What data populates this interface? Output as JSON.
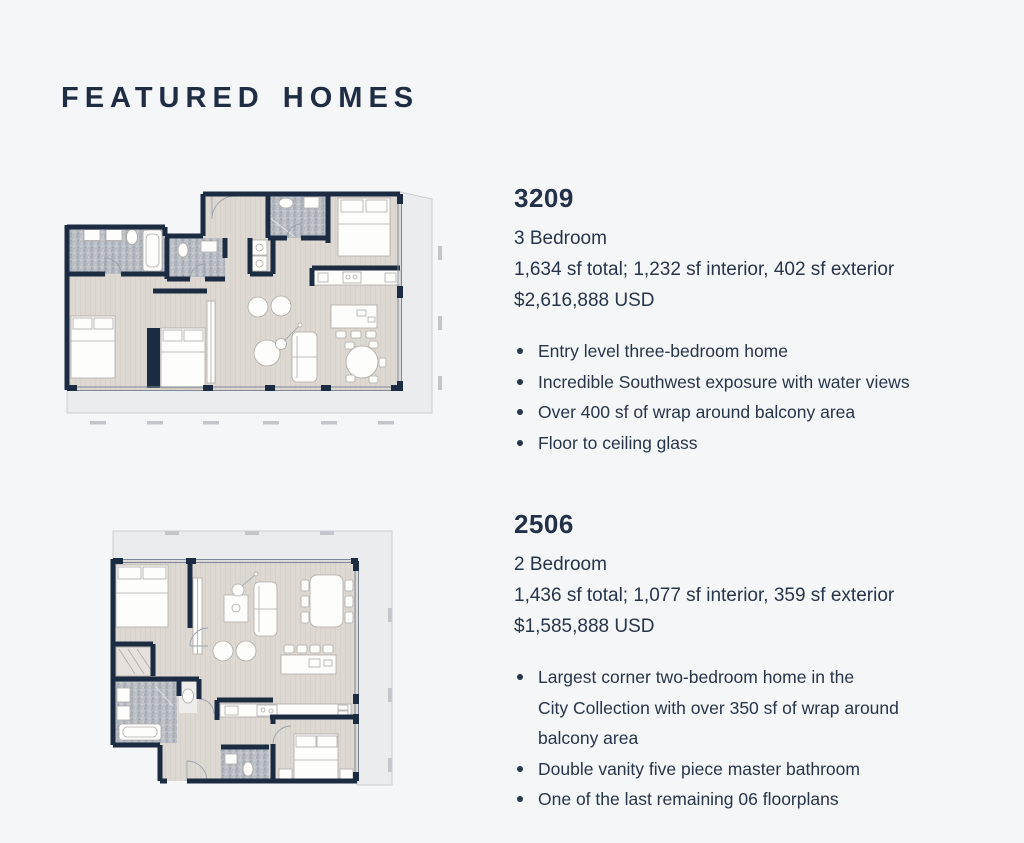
{
  "page": {
    "title": "FEATURED HOMES"
  },
  "colors": {
    "background": "#f5f6f7",
    "heading_text": "#1e2d44",
    "body_text": "#273449",
    "plan_wall": "#1b2b41",
    "plan_floor": "#ded8d2",
    "plan_tile": "#b9bdc3",
    "plan_balcony": "#ebecee"
  },
  "units": [
    {
      "id": "3209",
      "bedrooms": "3 Bedroom",
      "area": "1,634 sf total; 1,232 sf interior, 402 sf exterior",
      "price": "$2,616,888 USD",
      "bullets": [
        "Entry level three-bedroom home",
        "Incredible Southwest exposure with water views",
        "Over 400 sf of wrap around balcony area",
        "Floor to ceiling glass"
      ]
    },
    {
      "id": "2506",
      "bedrooms": "2 Bedroom",
      "area": "1,436 sf total; 1,077 sf interior, 359 sf exterior",
      "price": "$1,585,888 USD",
      "bullets": [
        "Largest corner two-bedroom home in the\nCity Collection with over 350 sf of wrap around\nbalcony area",
        "Double vanity five piece master bathroom",
        "One of the last remaining 06 floorplans"
      ]
    }
  ]
}
